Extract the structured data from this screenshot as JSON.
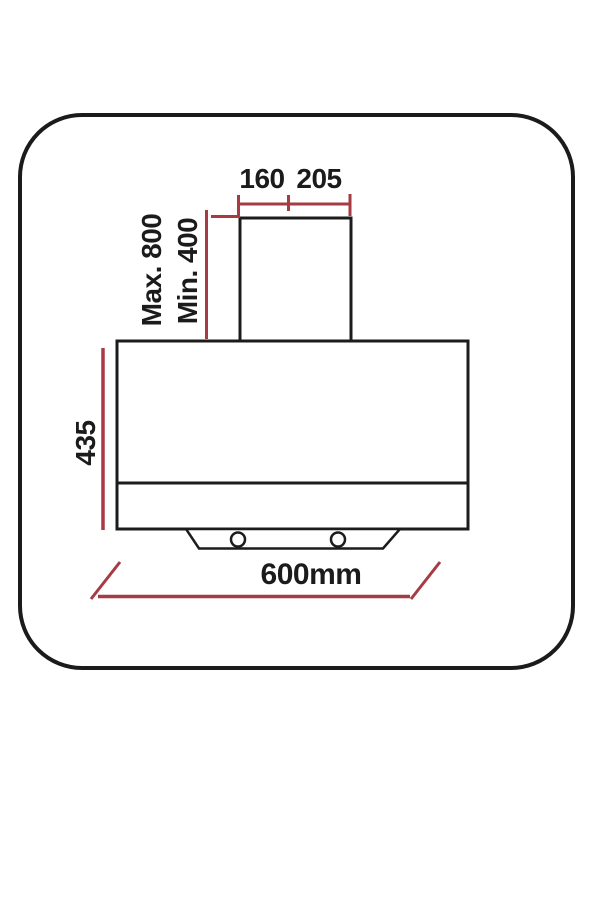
{
  "figure": {
    "type": "installation-dimension-diagram",
    "subject": "chimney cooker hood dimensions",
    "labels": {
      "duct_width_left": "160",
      "duct_width_right": "205",
      "mount_max": "Max. 800",
      "mount_min": "Min. 400",
      "body_height": "435",
      "overall_width": "600mm"
    },
    "colors": {
      "line": "#1c1c1c",
      "dimension": "#a63b44",
      "background": "#ffffff"
    }
  }
}
